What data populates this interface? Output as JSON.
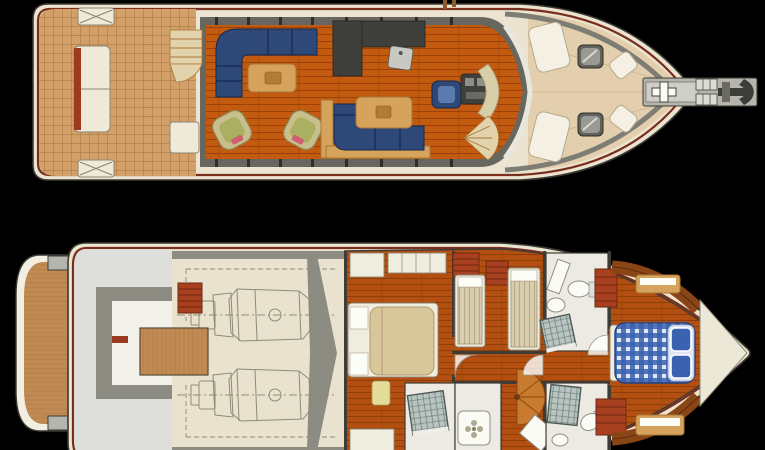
{
  "page": {
    "background": "#000000",
    "kind": "yacht-deck-plan-illustration",
    "views": [
      "main-deck-plan",
      "lower-deck-plan"
    ]
  },
  "decks": {
    "main_deck": {
      "name": "main-deck-plan",
      "features": [
        "swim-steps",
        "aft-deck-teak",
        "stern-bench-seat",
        "corner-steps",
        "aft-wet-bar-cabinet",
        "entry-staircase",
        "salon-l-sofa",
        "coffee-table",
        "wicker-armchair-port",
        "wicker-armchair-starboard",
        "dinette-l-sofa",
        "dinette-table",
        "galley-counters",
        "galley-sink",
        "helm-chair",
        "helm-console",
        "dashboard",
        "spiral-staircase",
        "windshield",
        "foredeck",
        "sunpad-port",
        "sunpad-starboard",
        "bow-pad-port",
        "bow-pad-starboard",
        "deck-hatch-port",
        "deck-hatch-starboard",
        "anchor-platform",
        "windlass",
        "chain-lockers",
        "anchor"
      ]
    },
    "lower_deck": {
      "name": "lower-deck-plan",
      "features": [
        "swim-platform-teak",
        "lazarette",
        "lazarette-walls",
        "engine-room",
        "engine-port",
        "engine-starboard",
        "engine-room-ladder",
        "teak-hatch",
        "master-cabin",
        "master-double-bed",
        "master-nightstands",
        "master-bench",
        "master-wardrobes",
        "master-ensuite-shower",
        "shower-tray",
        "twin-cabin",
        "twin-bed-port",
        "twin-bed-starboard",
        "red-lockers",
        "guest-head-toilet",
        "guest-head-sink",
        "guest-head-shower",
        "spiral-staircase-lower",
        "aft-head-shower",
        "aft-head-toilet",
        "vip-cabin",
        "vip-double-bed",
        "vip-pillows",
        "vip-benches",
        "vip-wood-cabinetry",
        "bow-locker-triangle",
        "door-arcs"
      ]
    }
  },
  "colors": {
    "bg": "#000000",
    "hull": "#ece4d0",
    "outline": "#3a3a34",
    "rubrail": "#7a2f1e",
    "teakAft": "#d4a06a",
    "teakLine": "#b0804a",
    "wallGray": "#68675f",
    "salonFloor": "#c25a10",
    "plankLine": "#9c4208",
    "navy": "#2e4878",
    "navyLine": "#16294e",
    "wood": "#d6a35c",
    "woodEdge": "#a87636",
    "wicker": "#c9bf8c",
    "wickerSeat": "#aab061",
    "accentPink": "#cf5f72",
    "counterDark": "#3f3f3b",
    "steel": "#c9c9c4",
    "dashboard": "#d9ceaa",
    "stairTan": "#e3d3ad",
    "foredeck": "#e3cfae",
    "padWhite": "#f4f0e4",
    "hatchDark": "#62625c",
    "hatchLight": "#9a9a94",
    "bulwark": "#7d7d74",
    "platformGray": "#b5b5ae",
    "anchorDark": "#3c3c38",
    "swimTeak": "#c08a52",
    "lazFloor": "#dededa",
    "lazWall": "#8c8c82",
    "lazWhite": "#f2f1ea",
    "engineFloor": "#e9e2cf",
    "engineLine": "#8f8a76",
    "cabinFloor": "#b34f10",
    "cabinPlank": "#8f3e06",
    "wallDark": "#3f3b35",
    "bedFrame": "#efece0",
    "bedBeige": "#d9c79c",
    "stripeBed": "#d9cdb0",
    "stripeLine": "#b8a888",
    "lockerRed": "#a84020",
    "lockerLine": "#6e2810",
    "vipBlue": "#3a62b0",
    "vipBlueLight": "#dfe6f2",
    "bathFloor": "#eceae2",
    "tileGray": "#b8c4c0",
    "tileLine": "#5a7068",
    "fixtureWhite": "#fbfbf6",
    "woodDark": "#8a4516",
    "woodGrain": "#5f2c0c",
    "bowWhite": "#ece8d8",
    "benchCream": "#efe9d8"
  }
}
